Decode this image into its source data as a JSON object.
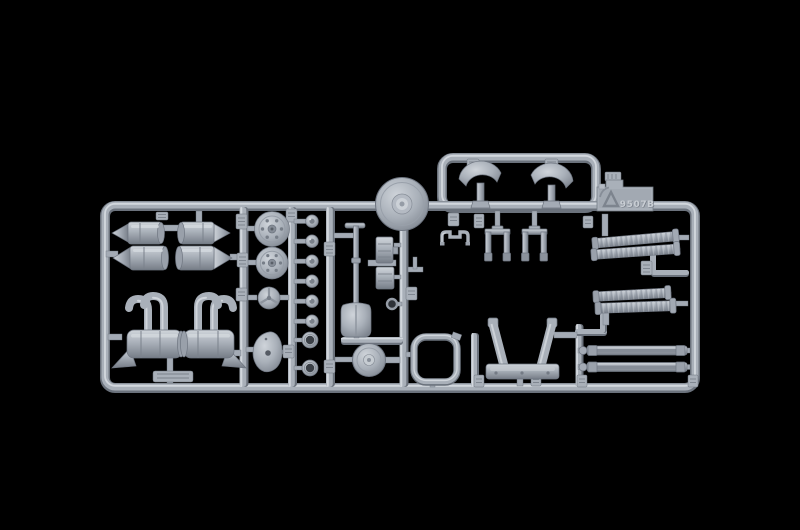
{
  "scene": {
    "type": "photograph",
    "subject": "Grey injection-molded model kit sprue (parts runner frame) on a black background",
    "background_color": "#000000",
    "plastic_color": "#a9b0b9",
    "plastic_highlight": "#d2d7dd",
    "plastic_shadow": "#6b727c"
  },
  "sprue": {
    "mold_code": "9507B",
    "logo": "recycling-arrows-icon",
    "parts_inventory": [
      {
        "name": "twin-cylinder-tank",
        "quantity": 2,
        "location": "upper-left"
      },
      {
        "name": "muffler-with-curved-exhaust-stubs",
        "quantity": 2,
        "location": "lower-left"
      },
      {
        "name": "bolted-hub-disc",
        "quantity": 2,
        "location": "left-center column"
      },
      {
        "name": "small-ribbed-disc",
        "quantity": 1,
        "location": "left-center column"
      },
      {
        "name": "mounting-plate",
        "quantity": 1,
        "location": "left-center column"
      },
      {
        "name": "dome-knob",
        "quantity": 6,
        "location": "center column"
      },
      {
        "name": "grommet-ring",
        "quantity": 2,
        "location": "center column"
      },
      {
        "name": "shovel",
        "quantity": 1,
        "location": "center"
      },
      {
        "name": "pulley-disc",
        "quantity": 1,
        "location": "top center"
      },
      {
        "name": "stacked-block-detail",
        "quantity": 2,
        "location": "center"
      },
      {
        "name": "rounded-frame-ring",
        "quantity": 1,
        "location": "bottom center"
      },
      {
        "name": "hub-disc",
        "quantity": 1,
        "location": "bottom center"
      },
      {
        "name": "u-bracket",
        "quantity": 1,
        "location": "center"
      },
      {
        "name": "axle-knuckle",
        "quantity": 2,
        "location": "center"
      },
      {
        "name": "crescent-fender",
        "quantity": 2,
        "location": "inside top handle loop"
      },
      {
        "name": "flexible-exhaust-pipe",
        "quantity": 4,
        "location": "right"
      },
      {
        "name": "leaf-spring-bar",
        "quantity": 2,
        "location": "lower right"
      },
      {
        "name": "tow-bar-a-frame",
        "quantity": 1,
        "location": "bottom center-right"
      },
      {
        "name": "part-number-tab",
        "quantity": 15,
        "location": "on runners"
      }
    ]
  }
}
